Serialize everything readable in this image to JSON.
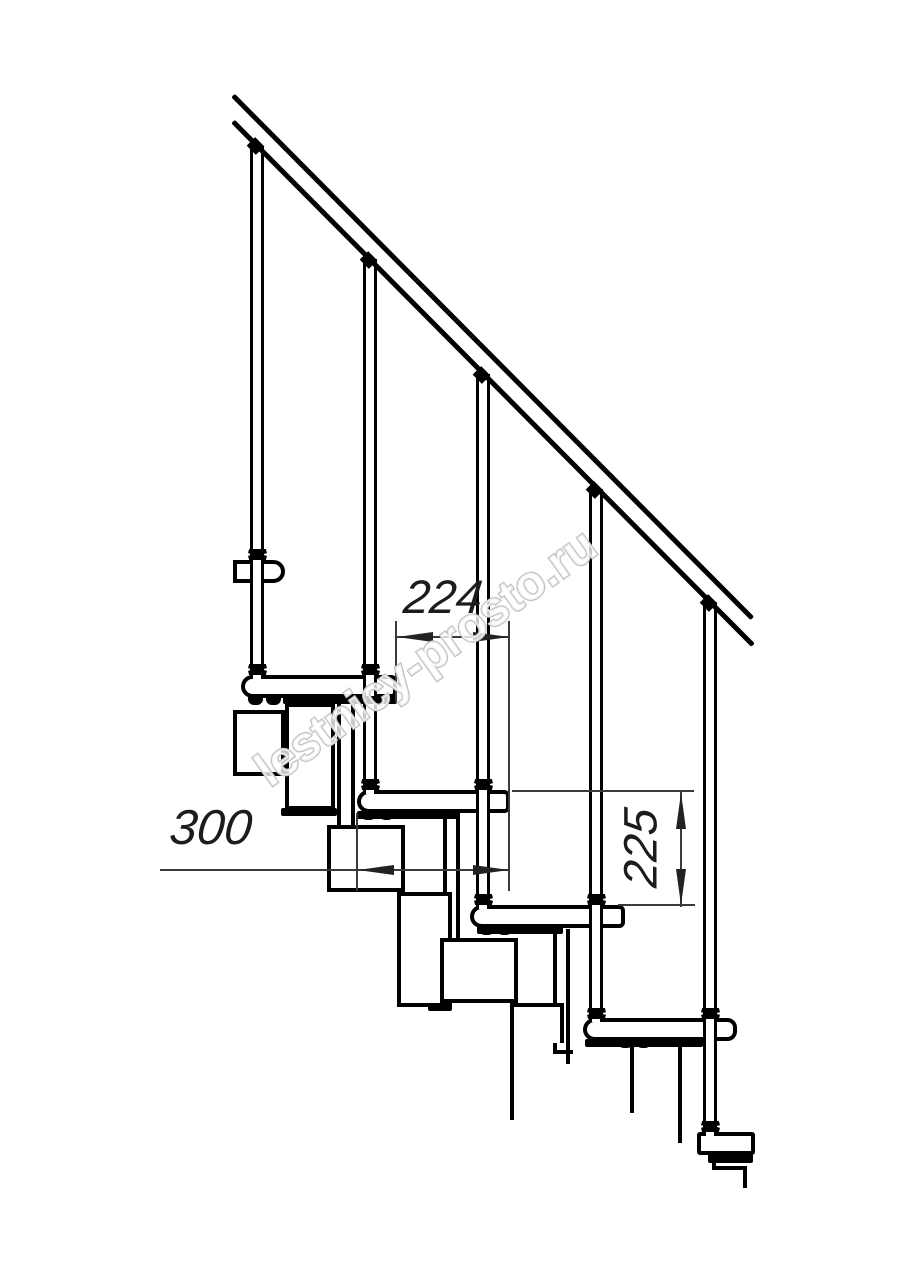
{
  "watermark": {
    "text": "lestnicy-prosto.ru",
    "outline_color": "#c2c2c2"
  },
  "dimensions": {
    "going": "224",
    "tread_depth": "300",
    "rise": "225"
  },
  "drawing": {
    "type": "modular-staircase-side-view",
    "balusters_count": 5,
    "treads_visible": 6,
    "line_color": "#000000",
    "dimension_line_color": "#3a3a3a",
    "background": "#ffffff"
  }
}
